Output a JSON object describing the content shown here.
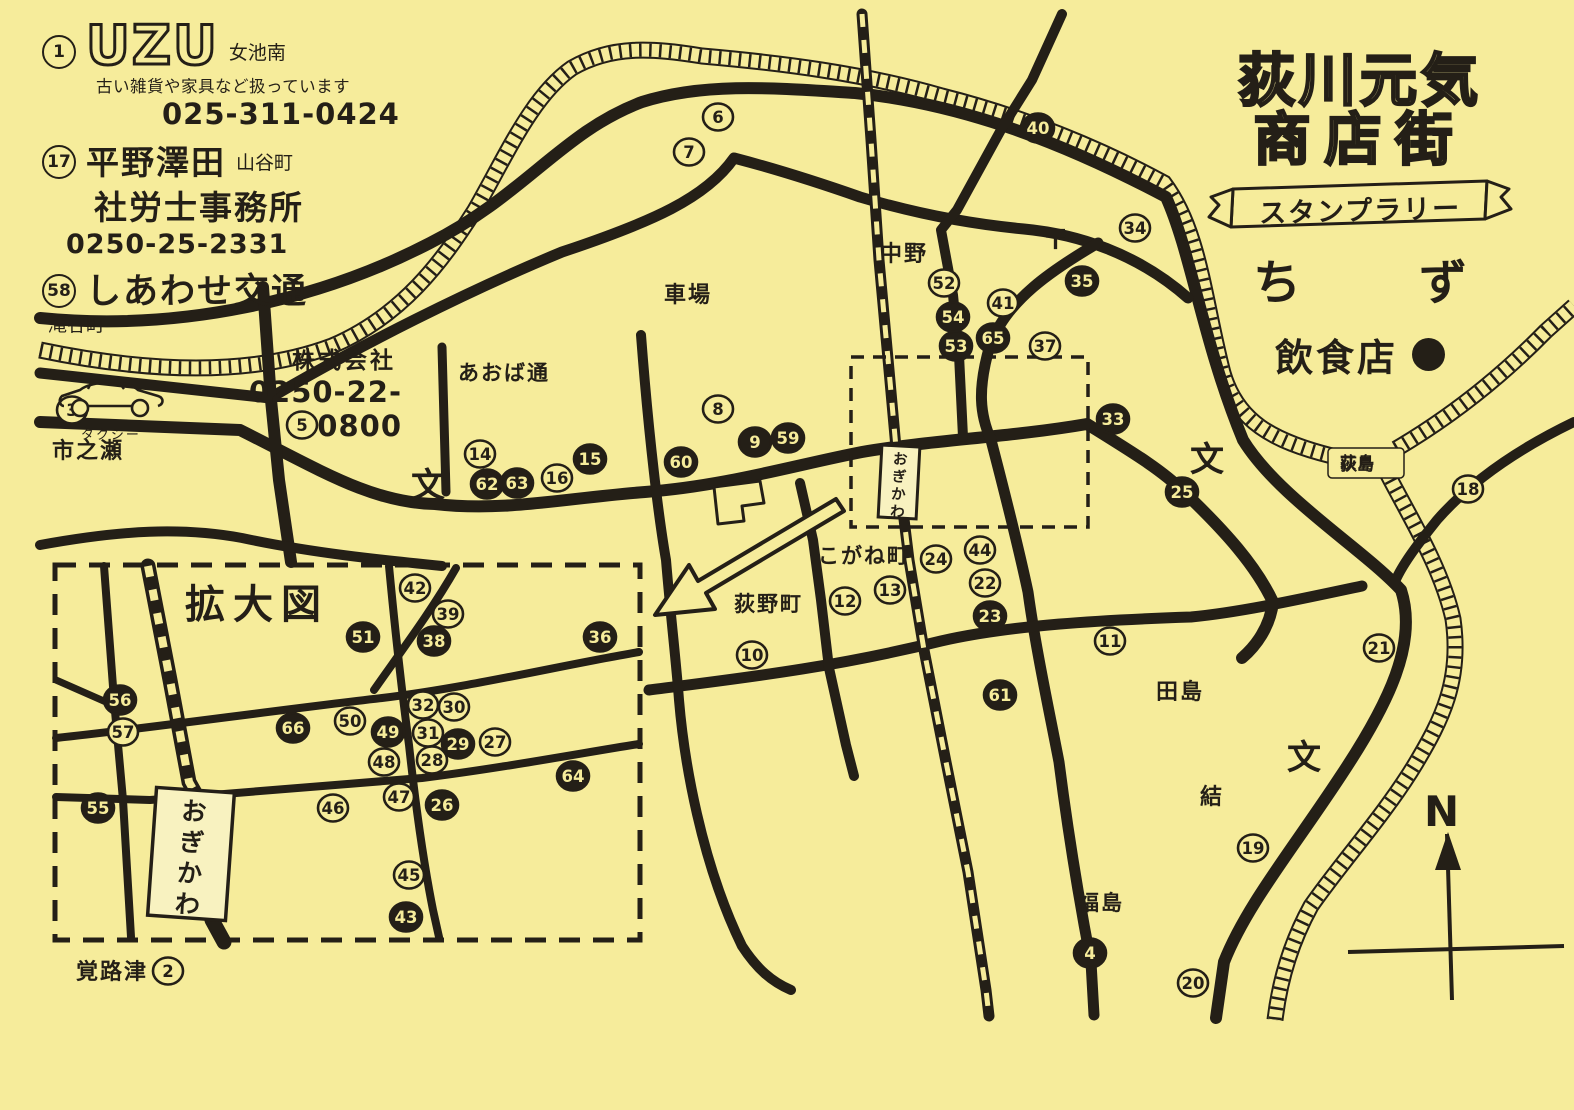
{
  "paper_color": "#f6ec9b",
  "ink_color": "#241f17",
  "header": {
    "title_line1": "荻川元気",
    "title_line2": "商店街",
    "banner": "スタンプラリー",
    "map_label_left": "ち",
    "map_label_right": "ず",
    "legend_label": "飲食店"
  },
  "ads": [
    {
      "number": "1",
      "logo": "UZU",
      "area": "女池南",
      "description": "古い雑貨や家具など扱っています",
      "phone": "025-311-0424"
    },
    {
      "number": "17",
      "name": "平野澤田",
      "area": "山谷町",
      "line2": "社労士事務所",
      "phone": "0250-25-2331"
    },
    {
      "number": "58",
      "name": "しあわせ交通",
      "area": "滝谷町",
      "line2": "株式会社",
      "vehicle_label": "タクシー",
      "phone": "0250-22-0800"
    }
  ],
  "inset_label": "拡大図",
  "station_name": "おぎかわ",
  "symbols": {
    "school": "文",
    "post": "〒",
    "north": "N"
  },
  "places": [
    {
      "name": "市之瀬",
      "x": 52,
      "y": 458,
      "size": 22
    },
    {
      "name": "あおば通",
      "x": 458,
      "y": 380,
      "size": 21
    },
    {
      "name": "車場",
      "x": 664,
      "y": 302,
      "size": 22
    },
    {
      "name": "中野",
      "x": 880,
      "y": 261,
      "size": 22
    },
    {
      "name": "こがね町",
      "x": 818,
      "y": 563,
      "size": 21
    },
    {
      "name": "荻野町",
      "x": 734,
      "y": 611,
      "size": 21
    },
    {
      "name": "田島",
      "x": 1156,
      "y": 699,
      "size": 22
    },
    {
      "name": "結",
      "x": 1200,
      "y": 804,
      "size": 22
    },
    {
      "name": "福島",
      "x": 1078,
      "y": 910,
      "size": 21
    },
    {
      "name": "覚路津",
      "x": 76,
      "y": 979,
      "size": 22
    },
    {
      "name": "荻島",
      "x": 1340,
      "y": 468,
      "size": 16
    }
  ],
  "schools": [
    {
      "x": 428,
      "y": 497
    },
    {
      "x": 1207,
      "y": 471
    },
    {
      "x": 1304,
      "y": 769
    }
  ],
  "post_office": {
    "x": 1042,
    "y": 249
  },
  "markers_main": [
    {
      "n": 2,
      "x": 168,
      "y": 971,
      "f": false
    },
    {
      "n": 3,
      "x": 72,
      "y": 410,
      "f": false
    },
    {
      "n": 4,
      "x": 1090,
      "y": 953,
      "f": true
    },
    {
      "n": 5,
      "x": 302,
      "y": 425,
      "f": false
    },
    {
      "n": 6,
      "x": 718,
      "y": 117,
      "f": false
    },
    {
      "n": 7,
      "x": 689,
      "y": 152,
      "f": false
    },
    {
      "n": 8,
      "x": 718,
      "y": 409,
      "f": false
    },
    {
      "n": 9,
      "x": 755,
      "y": 442,
      "f": true
    },
    {
      "n": 10,
      "x": 752,
      "y": 655,
      "f": false
    },
    {
      "n": 11,
      "x": 1110,
      "y": 641,
      "f": false
    },
    {
      "n": 12,
      "x": 845,
      "y": 601,
      "f": false
    },
    {
      "n": 13,
      "x": 890,
      "y": 590,
      "f": false
    },
    {
      "n": 14,
      "x": 480,
      "y": 454,
      "f": false
    },
    {
      "n": 15,
      "x": 590,
      "y": 459,
      "f": true
    },
    {
      "n": 16,
      "x": 557,
      "y": 478,
      "f": false
    },
    {
      "n": 18,
      "x": 1468,
      "y": 489,
      "f": false
    },
    {
      "n": 19,
      "x": 1253,
      "y": 848,
      "f": false
    },
    {
      "n": 20,
      "x": 1193,
      "y": 983,
      "f": false
    },
    {
      "n": 21,
      "x": 1379,
      "y": 648,
      "f": false
    },
    {
      "n": 22,
      "x": 985,
      "y": 583,
      "f": false
    },
    {
      "n": 23,
      "x": 990,
      "y": 616,
      "f": true
    },
    {
      "n": 24,
      "x": 936,
      "y": 559,
      "f": false
    },
    {
      "n": 25,
      "x": 1182,
      "y": 492,
      "f": true
    },
    {
      "n": 33,
      "x": 1113,
      "y": 419,
      "f": true
    },
    {
      "n": 34,
      "x": 1135,
      "y": 228,
      "f": false
    },
    {
      "n": 35,
      "x": 1082,
      "y": 281,
      "f": true
    },
    {
      "n": 37,
      "x": 1045,
      "y": 346,
      "f": false
    },
    {
      "n": 40,
      "x": 1038,
      "y": 128,
      "f": true
    },
    {
      "n": 41,
      "x": 1003,
      "y": 303,
      "f": false
    },
    {
      "n": 44,
      "x": 980,
      "y": 550,
      "f": false
    },
    {
      "n": 52,
      "x": 944,
      "y": 283,
      "f": false
    },
    {
      "n": 53,
      "x": 956,
      "y": 346,
      "f": true
    },
    {
      "n": 54,
      "x": 953,
      "y": 317,
      "f": true
    },
    {
      "n": 59,
      "x": 788,
      "y": 438,
      "f": true
    },
    {
      "n": 60,
      "x": 681,
      "y": 462,
      "f": true
    },
    {
      "n": 61,
      "x": 1000,
      "y": 695,
      "f": true
    },
    {
      "n": 62,
      "x": 487,
      "y": 484,
      "f": true
    },
    {
      "n": 63,
      "x": 517,
      "y": 483,
      "f": true
    },
    {
      "n": 65,
      "x": 993,
      "y": 338,
      "f": true
    }
  ],
  "markers_inset": [
    {
      "n": 26,
      "x": 442,
      "y": 805,
      "f": true
    },
    {
      "n": 27,
      "x": 495,
      "y": 742,
      "f": false
    },
    {
      "n": 28,
      "x": 432,
      "y": 760,
      "f": false
    },
    {
      "n": 29,
      "x": 458,
      "y": 744,
      "f": true
    },
    {
      "n": 30,
      "x": 454,
      "y": 707,
      "f": false
    },
    {
      "n": 31,
      "x": 428,
      "y": 733,
      "f": false
    },
    {
      "n": 32,
      "x": 423,
      "y": 705,
      "f": false
    },
    {
      "n": 36,
      "x": 600,
      "y": 637,
      "f": true
    },
    {
      "n": 38,
      "x": 434,
      "y": 641,
      "f": true
    },
    {
      "n": 39,
      "x": 448,
      "y": 614,
      "f": false
    },
    {
      "n": 42,
      "x": 415,
      "y": 588,
      "f": false
    },
    {
      "n": 43,
      "x": 406,
      "y": 917,
      "f": true
    },
    {
      "n": 45,
      "x": 409,
      "y": 875,
      "f": false
    },
    {
      "n": 46,
      "x": 333,
      "y": 808,
      "f": false
    },
    {
      "n": 47,
      "x": 399,
      "y": 797,
      "f": false
    },
    {
      "n": 48,
      "x": 384,
      "y": 762,
      "f": false
    },
    {
      "n": 49,
      "x": 388,
      "y": 732,
      "f": true
    },
    {
      "n": 50,
      "x": 350,
      "y": 721,
      "f": false
    },
    {
      "n": 51,
      "x": 363,
      "y": 637,
      "f": true
    },
    {
      "n": 55,
      "x": 98,
      "y": 808,
      "f": true
    },
    {
      "n": 56,
      "x": 120,
      "y": 700,
      "f": true
    },
    {
      "n": 57,
      "x": 123,
      "y": 732,
      "f": false
    },
    {
      "n": 64,
      "x": 573,
      "y": 776,
      "f": true
    },
    {
      "n": 66,
      "x": 293,
      "y": 728,
      "f": true
    }
  ]
}
